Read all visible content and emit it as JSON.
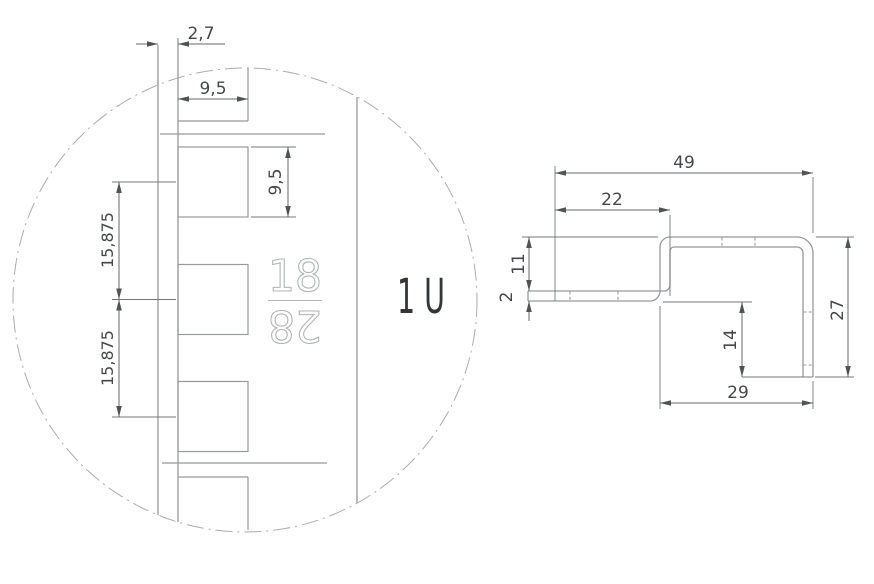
{
  "detail_view": {
    "title": "rack-rail-hole-pattern-detail",
    "dimensions": {
      "flange_offset": "2,7",
      "hole_width": "9,5",
      "hole_height": "9,5",
      "hole_pitch_upper": "15,875",
      "hole_pitch_lower": "15,875"
    },
    "stamp": {
      "top_number": "18",
      "bottom_number": "28"
    },
    "unit_label": "1 U"
  },
  "profile_view": {
    "title": "bracket-z-profile-section",
    "dimensions": {
      "overall_width": "49",
      "upper_offset": "22",
      "step_height": "11",
      "material_thickness": "2",
      "inner_leg": "14",
      "overall_height": "27",
      "bottom_width": "29"
    }
  },
  "colors": {
    "geometry_line": "#97999c",
    "dimension_line": "#64676a",
    "dimension_text": "#45474a",
    "stamp_outline": "#b1b3b5",
    "unit_text": "#333538",
    "background": "#ffffff"
  }
}
